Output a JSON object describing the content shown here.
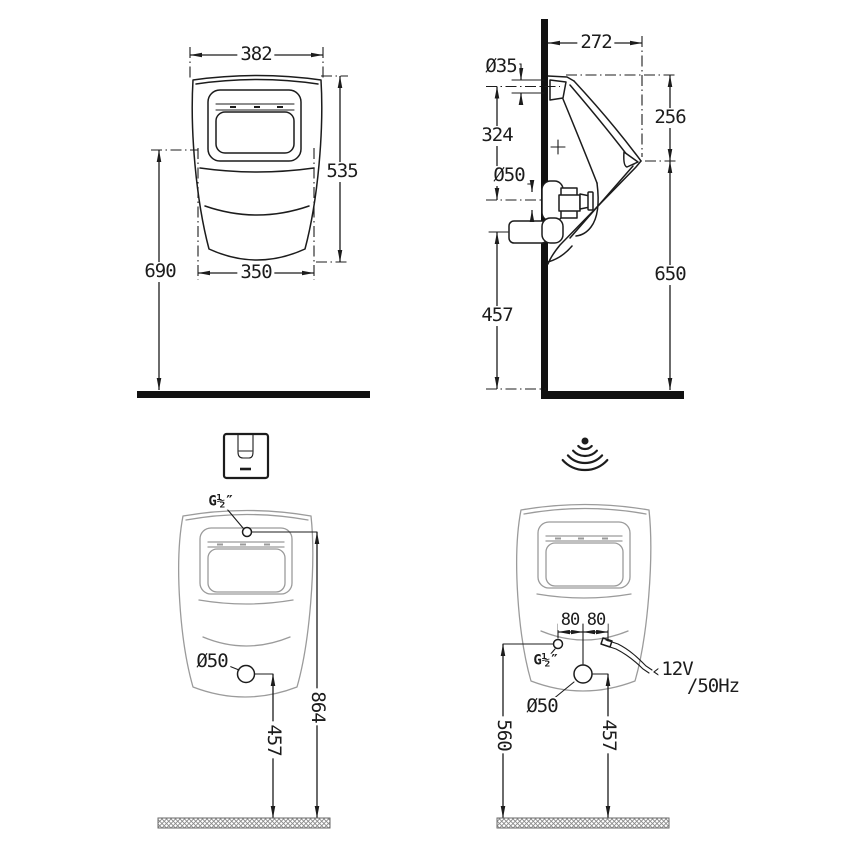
{
  "meta": {
    "drawing_type": "urinal installation dimension drawing",
    "background_color": "#ffffff",
    "line_color": "#1c1c1c",
    "light_outline_color": "#9b9b9b",
    "units": "mm"
  },
  "labels": {
    "front_installed": {
      "top_width": "382",
      "height": "535",
      "mount_height": "690",
      "bottom_width": "350"
    },
    "side_installed": {
      "depth": "272",
      "inlet_diameter": "Ø35",
      "inlet_drop": "324",
      "rim_drop": "256",
      "outlet_diameter": "Ø50",
      "rim_height": "650",
      "outlet_height": "457"
    },
    "front_manual": {
      "water_inlet": "G½″",
      "outlet_diameter": "Ø50",
      "inlet_height": "864",
      "outlet_height": "457"
    },
    "front_sensor": {
      "spacing_left": "80",
      "spacing_right": "80",
      "water_inlet": "G½″",
      "outlet_diameter": "Ø50",
      "inlet_height": "560",
      "outlet_height": "457",
      "voltage": "12V",
      "frequency": "/50Hz"
    }
  },
  "icons": {
    "manual": "flush-plate-icon",
    "sensor": "wireless-signal-icon"
  }
}
